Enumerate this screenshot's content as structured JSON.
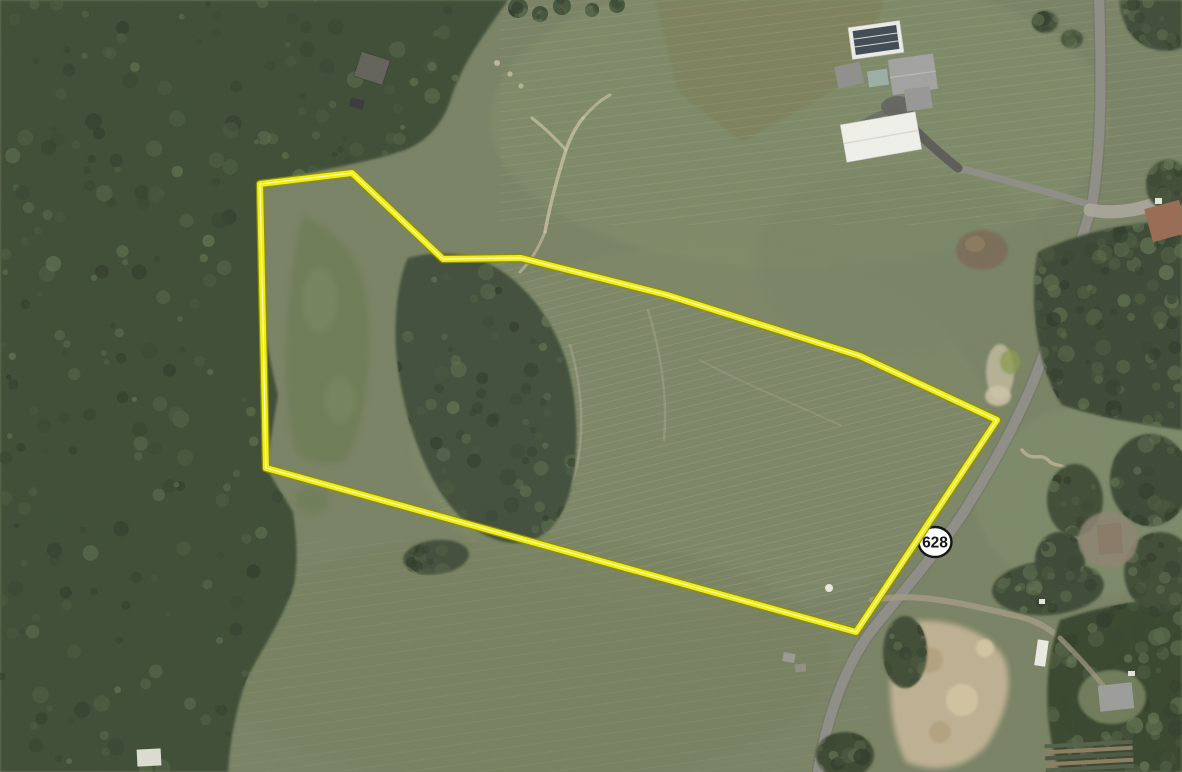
{
  "map": {
    "description": "Aerial imagery of a rural property with highlighted parcel boundary along State Route 628",
    "route_marker": {
      "label": "628",
      "shape": "oval-shield",
      "fill": "#ffffff",
      "border": "#151515"
    },
    "parcel_boundary": {
      "points": "260,184 352,173 443,259 521,258 667,295 860,356 997,420 856,632 266,468",
      "casing_color": "#8f8f00",
      "stroke_color": "#f2ee00",
      "highlight_color": "#fffdea"
    },
    "features": {
      "road_main": "State Route 628",
      "farm_complex": "farmhouse with barn and outbuildings",
      "terrain": [
        "forest",
        "pasture",
        "meadow",
        "dirt clearing",
        "garden rows"
      ]
    },
    "palette": {
      "field": "#798262",
      "field_light": "#828f69",
      "field_dark": "#76815d",
      "field_olive": "#7d8058",
      "meadow": "#6d7c52",
      "forest": "#3e4d36",
      "forest_dark": "#39462f",
      "road": "#8e8e86",
      "road_light": "#aaa69a",
      "driveway_dark": "#5c5c58",
      "dirt": "#c6b694",
      "trail": "#cdc3a2"
    }
  }
}
